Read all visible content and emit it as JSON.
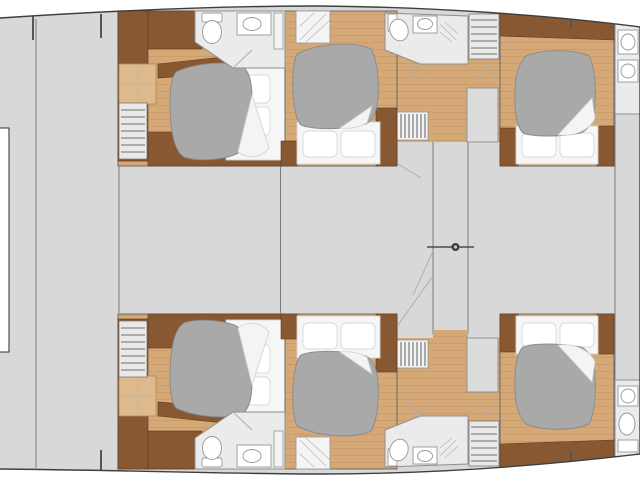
{
  "meta": {
    "title": "Yacht lower-deck floor plan",
    "diagram_type": "floor-plan",
    "view": "top-down",
    "visible_text": "none"
  },
  "colors": {
    "bg": "#ffffff",
    "deck": "#d8d8d8",
    "wood": "#d5a977",
    "wood-line": "#c3945f",
    "wood-step": "#deb98b",
    "cabinet": "#875832",
    "cabinet-edge": "#5e3a1c",
    "duvet": "#a9a9a9",
    "duvet-edge": "#8d8d8d",
    "linen": "#f6f6f6",
    "linen-edge": "#d2d2d2",
    "bath": "#ebebeb",
    "bath-edge": "#8f8f8f",
    "wall": "#7d7d7d",
    "hull": "#3f3f3f",
    "fixture-edge": "#979797",
    "stair": "#e9e9e9",
    "stair-line": "#6e6e6e",
    "panel": "#dcdcdc",
    "swing": "#ababab",
    "knob": "#3c3c3c"
  },
  "inventory": {
    "guest_cabins": 6,
    "double_beds": 6,
    "bathrooms": 6,
    "staircases": 4,
    "passage_doors": 1,
    "deck_hatches": 1
  },
  "rooms": [
    {
      "id": "cabin-upper-left",
      "kind": "guest-cabin"
    },
    {
      "id": "cabin-upper-center",
      "kind": "guest-cabin"
    },
    {
      "id": "cabin-upper-right",
      "kind": "guest-cabin"
    },
    {
      "id": "cabin-lower-left",
      "kind": "guest-cabin"
    },
    {
      "id": "cabin-lower-center",
      "kind": "guest-cabin"
    },
    {
      "id": "cabin-lower-right",
      "kind": "guest-cabin"
    },
    {
      "id": "bathroom-upper-left",
      "kind": "bathroom"
    },
    {
      "id": "bathroom-upper-center",
      "kind": "bathroom"
    },
    {
      "id": "bathroom-upper-right",
      "kind": "bathroom"
    },
    {
      "id": "bathroom-lower-left",
      "kind": "bathroom"
    },
    {
      "id": "bathroom-lower-center",
      "kind": "bathroom"
    },
    {
      "id": "bathroom-lower-right",
      "kind": "bathroom"
    },
    {
      "id": "saloon",
      "kind": "open-deck-area"
    },
    {
      "id": "central-corridor",
      "kind": "passage"
    },
    {
      "id": "foredeck-area",
      "kind": "open-deck-area"
    }
  ]
}
